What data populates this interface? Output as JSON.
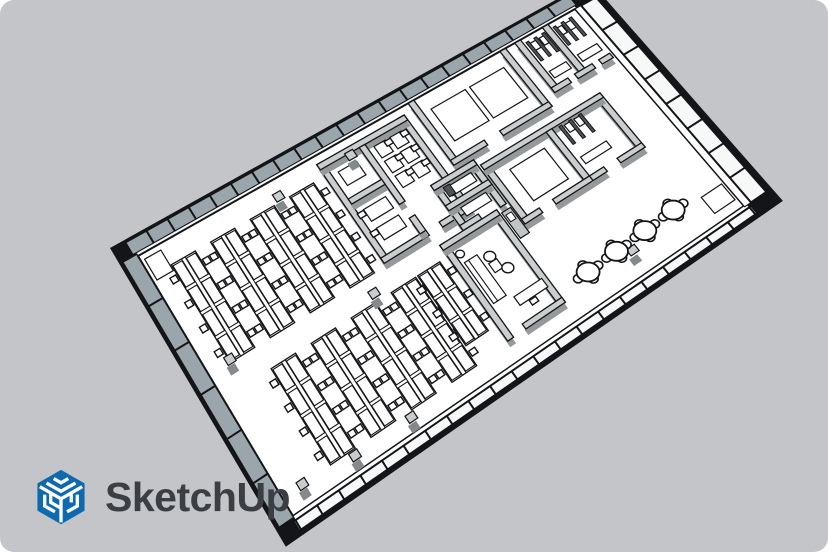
{
  "canvas": {
    "width": 828,
    "height": 552,
    "background": "#c3c5c8",
    "page_background": "#ffffff",
    "corner_radius": 14
  },
  "logo": {
    "wordmark": "SketchUp",
    "icon": "sketchup-cube-logo",
    "brand_blue": "#0e6aae",
    "wordmark_color": "#3b3f44"
  },
  "scene": {
    "description": "Isometric 3D office floor plan model",
    "corners": {
      "w": [
        138,
        256
      ],
      "n": [
        575,
        9
      ],
      "e": [
        744,
        206
      ],
      "s": [
        293,
        516
      ]
    },
    "palette": {
      "line": "#141518",
      "floor": "#ffffff",
      "wall_top": "#cbcecf",
      "wall_shadow": "#95999c",
      "glass": "#9aa5ac",
      "white_face": "#f7f8f8",
      "column_top": "#c9cdce",
      "column_side": "#83898c",
      "dark_fixture": "#4e5357",
      "gray_furniture": "#c2c5c6"
    },
    "perimeter": {
      "back_mullions": 21,
      "front_mullions": 21,
      "left_mullions": 6,
      "right_mullions": 8
    },
    "walls": [
      [
        0.398,
        0.03,
        0.411,
        0.45
      ],
      [
        0.585,
        0.03,
        0.598,
        0.45
      ],
      [
        0.398,
        0.03,
        0.598,
        0.052
      ],
      [
        0.398,
        0.428,
        0.5,
        0.45
      ],
      [
        0.53,
        0.428,
        0.598,
        0.45
      ],
      [
        0.487,
        0.052,
        0.5,
        0.3
      ],
      [
        0.487,
        0.36,
        0.5,
        0.428
      ],
      [
        0.411,
        0.19,
        0.487,
        0.212
      ],
      [
        0.618,
        0.0,
        0.631,
        0.28
      ],
      [
        0.828,
        0.0,
        0.841,
        0.28
      ],
      [
        0.618,
        0.258,
        0.695,
        0.28
      ],
      [
        0.73,
        0.258,
        0.841,
        0.28
      ],
      [
        0.862,
        0.0,
        0.875,
        0.24
      ],
      [
        0.925,
        0.0,
        0.938,
        0.218
      ],
      [
        0.862,
        0.218,
        0.9,
        0.24
      ],
      [
        0.915,
        0.218,
        0.955,
        0.24
      ],
      [
        0.97,
        0.218,
        0.995,
        0.24
      ],
      [
        0.558,
        0.3,
        0.571,
        0.5
      ],
      [
        0.642,
        0.3,
        0.655,
        0.5
      ],
      [
        0.558,
        0.3,
        0.655,
        0.322
      ],
      [
        0.558,
        0.39,
        0.655,
        0.412
      ],
      [
        0.558,
        0.478,
        0.6,
        0.5
      ],
      [
        0.66,
        0.33,
        0.673,
        0.6
      ],
      [
        0.917,
        0.33,
        0.93,
        0.6
      ],
      [
        0.66,
        0.33,
        0.93,
        0.352
      ],
      [
        0.8,
        0.352,
        0.813,
        0.6
      ],
      [
        0.66,
        0.578,
        0.7,
        0.6
      ],
      [
        0.73,
        0.578,
        0.813,
        0.6
      ],
      [
        0.813,
        0.578,
        0.845,
        0.6
      ],
      [
        0.875,
        0.578,
        0.93,
        0.6
      ],
      [
        0.505,
        0.5,
        0.518,
        0.92
      ],
      [
        0.62,
        0.5,
        0.633,
        0.92
      ],
      [
        0.505,
        0.5,
        0.633,
        0.522
      ],
      [
        0.545,
        0.898,
        0.633,
        0.92
      ]
    ],
    "desk_banks": [
      {
        "u": 0.075,
        "v0": 0.08,
        "v1": 0.46,
        "w": 0.055,
        "rows": 4
      },
      {
        "u": 0.165,
        "v0": 0.08,
        "v1": 0.46,
        "w": 0.055,
        "rows": 4
      },
      {
        "u": 0.255,
        "v0": 0.08,
        "v1": 0.46,
        "w": 0.055,
        "rows": 4
      },
      {
        "u": 0.345,
        "v0": 0.08,
        "v1": 0.46,
        "w": 0.055,
        "rows": 4
      },
      {
        "u": 0.135,
        "v0": 0.55,
        "v1": 0.93,
        "w": 0.055,
        "rows": 4
      },
      {
        "u": 0.225,
        "v0": 0.55,
        "v1": 0.93,
        "w": 0.055,
        "rows": 4
      },
      {
        "u": 0.315,
        "v0": 0.55,
        "v1": 0.93,
        "w": 0.055,
        "rows": 4
      },
      {
        "u": 0.405,
        "v0": 0.55,
        "v1": 0.93,
        "w": 0.055,
        "rows": 4
      },
      {
        "u": 0.462,
        "v0": 0.55,
        "v1": 0.85,
        "w": 0.05,
        "rows": 3
      }
    ],
    "white_rects": [
      [
        0.648,
        0.06,
        0.726,
        0.205
      ],
      [
        0.736,
        0.06,
        0.814,
        0.205
      ],
      [
        0.7,
        0.4,
        0.778,
        0.545
      ],
      [
        0.512,
        0.075,
        0.538,
        0.125
      ],
      [
        0.548,
        0.075,
        0.574,
        0.125
      ],
      [
        0.512,
        0.14,
        0.538,
        0.19
      ],
      [
        0.548,
        0.14,
        0.574,
        0.19
      ],
      [
        0.512,
        0.205,
        0.538,
        0.255
      ],
      [
        0.548,
        0.205,
        0.574,
        0.255
      ],
      [
        0.425,
        0.09,
        0.467,
        0.148
      ],
      [
        0.424,
        0.25,
        0.474,
        0.3
      ],
      [
        0.424,
        0.33,
        0.474,
        0.38
      ],
      [
        0.524,
        0.6,
        0.552,
        0.78
      ],
      [
        0.56,
        0.65,
        0.578,
        0.69
      ],
      [
        0.562,
        0.8,
        0.624,
        0.838
      ],
      [
        0.58,
        0.335,
        0.636,
        0.372
      ],
      [
        0.58,
        0.425,
        0.636,
        0.462
      ],
      [
        0.88,
        0.16,
        0.918,
        0.192
      ],
      [
        0.944,
        0.16,
        0.988,
        0.192
      ],
      [
        0.822,
        0.5,
        0.88,
        0.532
      ],
      [
        0.884,
        0.03,
        0.898,
        0.064
      ],
      [
        0.906,
        0.03,
        0.92,
        0.064
      ],
      [
        0.944,
        0.03,
        0.958,
        0.064
      ],
      [
        0.966,
        0.03,
        0.98,
        0.064
      ],
      [
        0.836,
        0.365,
        0.848,
        0.4
      ],
      [
        0.858,
        0.365,
        0.87,
        0.4
      ],
      [
        0.95,
        0.88,
        0.995,
        0.96
      ],
      [
        0.008,
        0.02,
        0.045,
        0.1
      ]
    ],
    "gray_rects": [
      [
        0.637,
        0.52,
        0.657,
        0.635
      ]
    ],
    "dark_rects": [
      [
        0.88,
        0.02,
        0.886,
        0.11
      ],
      [
        0.898,
        0.02,
        0.904,
        0.11
      ],
      [
        0.916,
        0.02,
        0.922,
        0.11
      ],
      [
        0.942,
        0.02,
        0.948,
        0.11
      ],
      [
        0.96,
        0.02,
        0.966,
        0.11
      ],
      [
        0.978,
        0.02,
        0.984,
        0.11
      ],
      [
        0.826,
        0.36,
        0.832,
        0.445
      ],
      [
        0.848,
        0.36,
        0.854,
        0.445
      ],
      [
        0.87,
        0.36,
        0.876,
        0.445
      ],
      [
        0.575,
        0.33,
        0.589,
        0.37
      ]
    ],
    "lines": [
      [
        0.533,
        0.6,
        0.533,
        0.78
      ]
    ],
    "chairs": [
      [
        0.541,
        0.088
      ],
      [
        0.541,
        0.153
      ],
      [
        0.541,
        0.218
      ],
      [
        0.577,
        0.088
      ],
      [
        0.577,
        0.153
      ],
      [
        0.577,
        0.218
      ],
      [
        0.416,
        0.262
      ],
      [
        0.416,
        0.342
      ],
      [
        0.588,
        0.852
      ]
    ],
    "dots": [
      [
        0.57,
        0.63,
        6
      ],
      [
        0.585,
        0.7,
        6
      ],
      [
        0.527,
        0.565,
        4.5
      ]
    ],
    "columns": [
      [
        0.05,
        0.45
      ],
      [
        0.3,
        0.06
      ],
      [
        0.35,
        0.52
      ],
      [
        0.155,
        0.95
      ],
      [
        0.28,
        0.95
      ],
      [
        0.045,
        0.93
      ],
      [
        0.79,
        0.9
      ],
      [
        0.465,
        0.06
      ]
    ],
    "round_tables": [
      [
        0.7,
        0.875
      ],
      [
        0.765,
        0.87
      ],
      [
        0.83,
        0.865
      ],
      [
        0.895,
        0.86
      ]
    ]
  }
}
